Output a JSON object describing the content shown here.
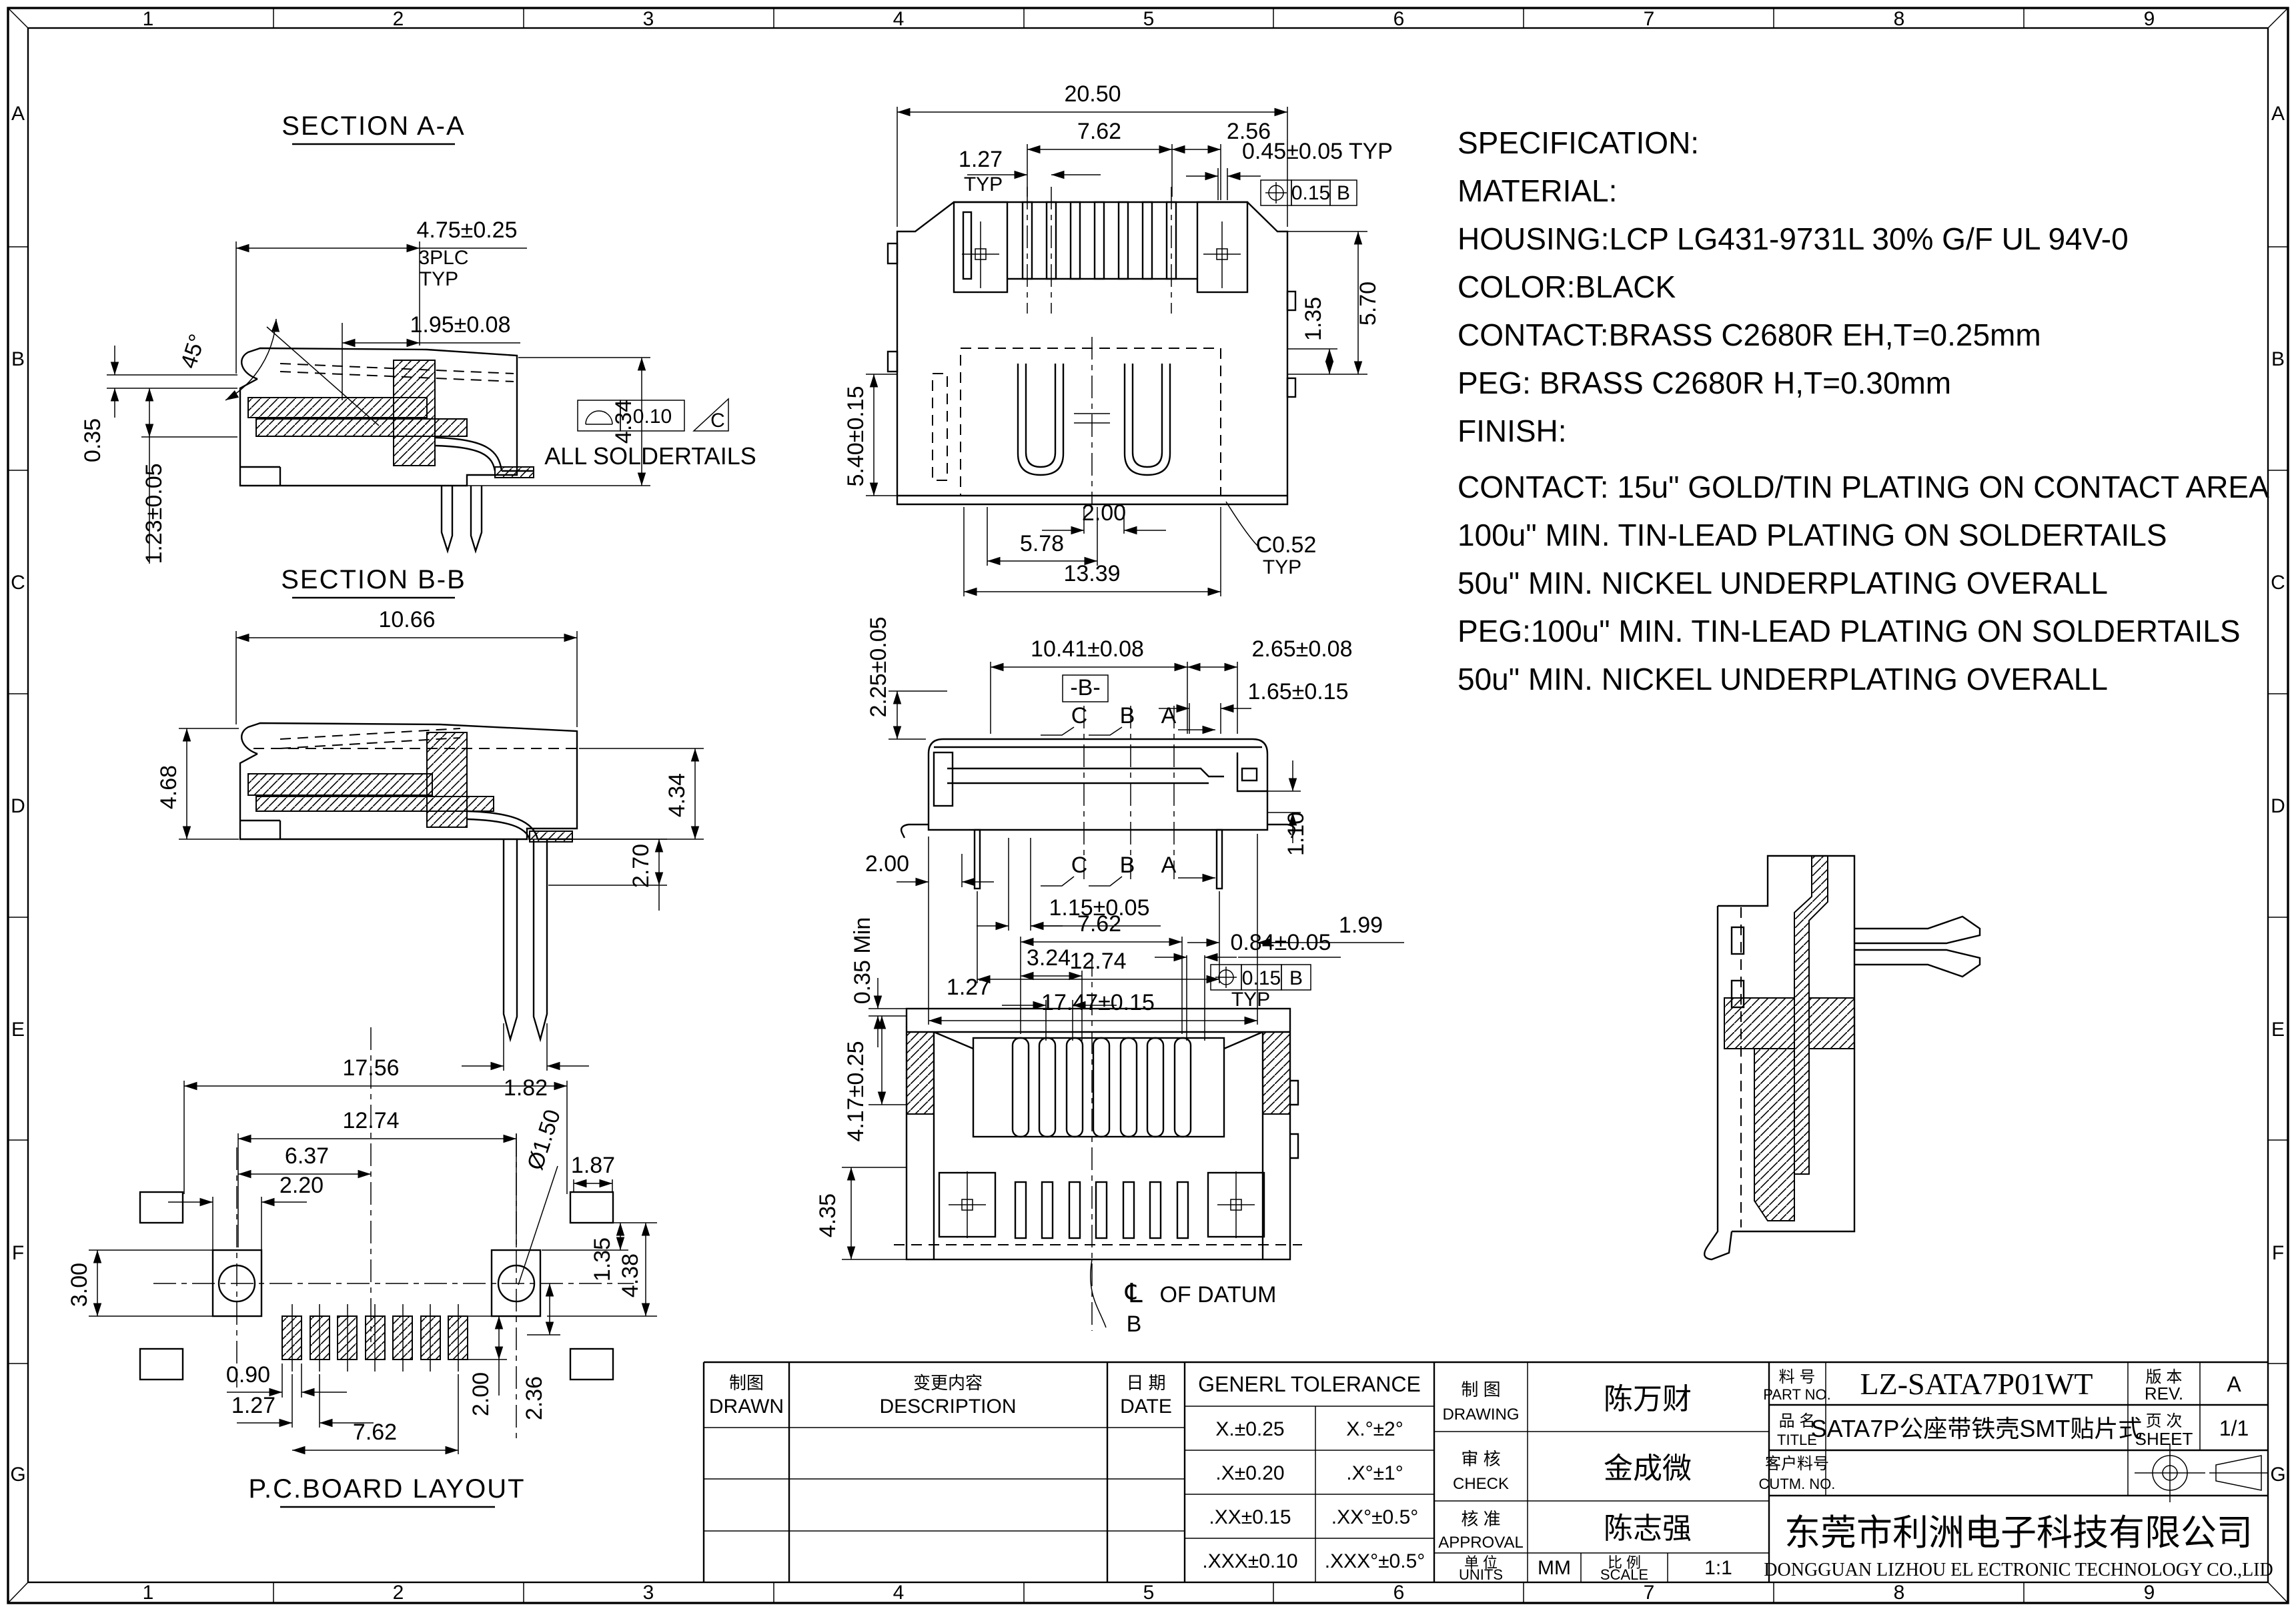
{
  "sheet": {
    "border": {
      "cols": [
        "1",
        "2",
        "3",
        "4",
        "5",
        "6",
        "7",
        "8",
        "9"
      ],
      "rows": [
        "A",
        "B",
        "C",
        "D",
        "E",
        "F",
        "G"
      ]
    },
    "spec": {
      "lines": [
        "SPECIFICATION:",
        "MATERIAL:",
        "HOUSING:LCP LG431-9731L 30% G/F UL 94V-0",
        "COLOR:BLACK",
        "CONTACT:BRASS C2680R EH,T=0.25mm",
        "PEG: BRASS C2680R H,T=0.30mm",
        "FINISH:",
        "CONTACT: 15u\" GOLD/TIN PLATING ON CONTACT AREA",
        "100u\" MIN. TIN-LEAD PLATING ON SOLDERTAILS",
        "50u\" MIN. NICKEL UNDERPLATING OVERALL",
        "PEG:100u\" MIN. TIN-LEAD PLATING ON SOLDERTAILS",
        "50u\" MIN. NICKEL UNDERPLATING OVERALL"
      ]
    },
    "views": {
      "section_aa": {
        "title": "SECTION A-A",
        "dim_width": "4.75±0.25",
        "dim_width_note1": "3PLC",
        "dim_width_note2": "TYP",
        "dim_pin": "1.95±0.08",
        "dim_angle": "45°",
        "dim_lip": "0.35",
        "dim_seat": "1.23±0.05",
        "dim_height": "4.34",
        "fcf_tol": "0.10",
        "fcf_datum": "C",
        "note": "ALL SOLDERTAILS"
      },
      "section_bb": {
        "title": "SECTION B-B",
        "dim_width": "10.66",
        "dim_left_h": "4.68",
        "dim_right_h": "4.34",
        "dim_tail": "2.70",
        "dim_fork": "1.82"
      },
      "pcb": {
        "title": "P.C.BOARD LAYOUT",
        "dim_outer": "17.56",
        "dim_holes": "12.74",
        "dim_hole_cl": "6.37",
        "dim_hole_w": "2.20",
        "dim_hole_d": "Ø1.50",
        "dim_pad": "1.87",
        "dim_side": "3.00",
        "dim_gap": "1.35",
        "dim_pad_h": "4.38",
        "dim_pad_w": "0.90",
        "dim_pitch": "1.27",
        "dim_span": "7.62",
        "dim_pad_len": "2.00",
        "dim_offset": "2.36"
      },
      "front": {
        "dim_w": "20.50",
        "dim_pins": "7.62",
        "dim_end": "2.56",
        "dim_pitch": "1.27",
        "typ1": "TYP",
        "dim_pin_w": "0.45±0.05 TYP",
        "fcf_tol": "0.15",
        "fcf_datum": "B",
        "dim_step": "1.35",
        "dim_h": "5.70",
        "dim_shell": "5.40±0.15",
        "dim_key": "2.00",
        "dim_slot": "5.78",
        "dim_open": "13.39",
        "chamfer": "C0.52",
        "typ2": "TYP"
      },
      "side": {
        "dim_top": "2.25±0.05",
        "dim_len": "10.41±0.08",
        "datum": "-B-",
        "dim_end": "2.65±0.08",
        "dim_tip": "1.65±0.15",
        "cut_c": "C",
        "cut_b": "B",
        "cut_a": "A",
        "dim_foot": "2.00",
        "dim_pin": "1.15±0.05",
        "dim_tail": "1.99",
        "dim_pins": "12.74",
        "dim_total": "17.47±0.15",
        "dim_notch": "1.10"
      },
      "bottom": {
        "dim_span": "7.62",
        "dim_key": "3.24",
        "dim_pitch": "1.27",
        "dim_slot": "0.84±0.05",
        "fcf_tol": "0.15",
        "fcf_datum": "B",
        "typ": "TYP",
        "dim_lip": "0.35 Min",
        "dim_depth": "4.17±0.25",
        "dim_tail": "4.35",
        "cl": "℄",
        "note": "OF DATUM",
        "datum": "B"
      }
    },
    "tables": {
      "revision": {
        "drawn_cn": "制图",
        "drawn": "DRAWN",
        "desc_cn": "变更内容",
        "desc": "DESCRIPTION",
        "date_cn": "日 期",
        "date": "DATE"
      },
      "tolerance": {
        "header": "GENERL TOLERANCE",
        "rows": [
          [
            "X.±0.25",
            "X.°±2°"
          ],
          [
            ".X±0.20",
            ".X°±1°"
          ],
          [
            ".XX±0.15",
            ".XX°±0.5°"
          ],
          [
            ".XXX±0.10",
            ".XXX°±0.5°"
          ]
        ]
      },
      "approval": {
        "drawing_cn": "制 图",
        "drawing": "DRAWING",
        "drawing_name": "陈万财",
        "check_cn": "审 核",
        "check": "CHECK",
        "check_name": "金成微",
        "approval_cn": "核 准",
        "approval": "APPROVAL",
        "approval_name": "陈志强",
        "units_cn": "单 位",
        "units": "UNITS",
        "units_value": "MM",
        "scale_cn": "比 例",
        "scale": "SCALE",
        "scale_value": "1:1"
      },
      "title_block": {
        "part_cn": "料 号",
        "part": "PART NO.",
        "part_value": "LZ-SATA7P01WT",
        "rev_cn": "版 本",
        "rev": "REV.",
        "rev_value": "A",
        "title_cn": "品 名",
        "title": "TITLE",
        "title_value": "SATA7P公座带铁壳SMT贴片式",
        "sheet_cn": "页 次",
        "sheet": "SHEET",
        "sheet_value": "1/1",
        "cust_cn": "客户料号",
        "cust": "CUTM. NO.",
        "company_cn": "东莞市利洲电子科技有限公司",
        "company_en": "DONGGUAN LIZHOU EL ECTRONIC TECHNOLOGY CO.,LID"
      }
    }
  }
}
